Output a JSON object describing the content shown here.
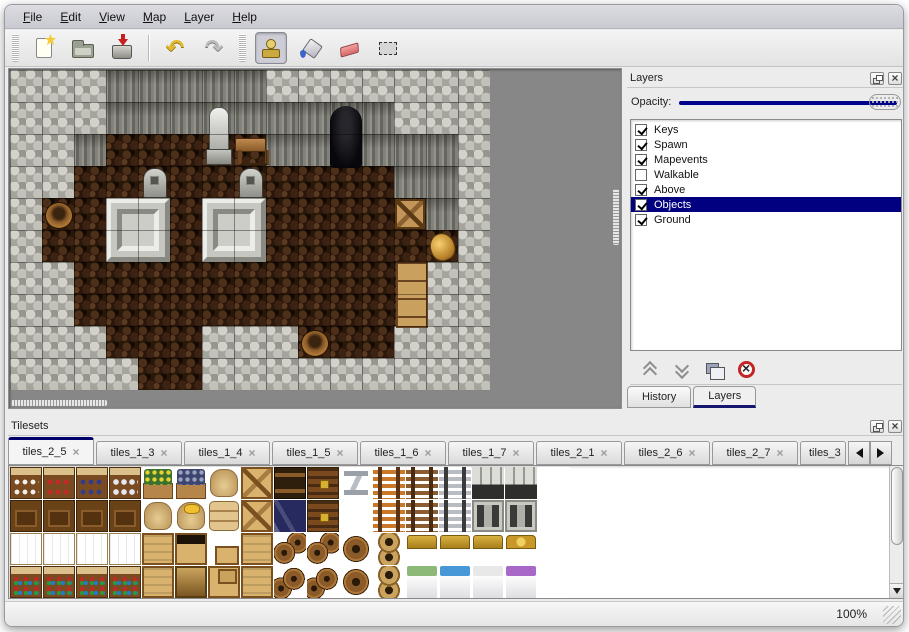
{
  "menu": {
    "items": [
      {
        "label": "File"
      },
      {
        "label": "Edit"
      },
      {
        "label": "View"
      },
      {
        "label": "Map"
      },
      {
        "label": "Layer"
      },
      {
        "label": "Help"
      }
    ]
  },
  "toolbar": {
    "items": [
      "grip",
      "new",
      "open",
      "save",
      "sep",
      "undo",
      "redo",
      "grip",
      "stamp",
      "fill",
      "eraser",
      "select"
    ],
    "active_tool": "stamp"
  },
  "map": {
    "tile_size": 32,
    "legend": {
      "R": "rock",
      "W": "wall",
      "F": "floor"
    },
    "grid": [
      "RRRWWWWWRRRRRRR",
      "RRRWWWWWWWWWRRR",
      "RRWFFFFFWWWWWWR",
      "RRFFFFFFFFFFWWR",
      "RFFFFFFFFFFFFWR",
      "RFFFFFFFFFFFFFR",
      "RRFFFFFFFFFFFRR",
      "RRFFFFFFFFFFFRR",
      "RRRFFFRRRFFFRRR",
      "RRRRFFRRRRRRRRR"
    ],
    "objects": [
      {
        "type": "cave",
        "col": 10,
        "row": 1
      },
      {
        "type": "statue",
        "col": 6,
        "row": 1
      },
      {
        "type": "table",
        "col": 7,
        "row": 2
      },
      {
        "type": "tombstone",
        "col": 4,
        "row": 3
      },
      {
        "type": "tombstone",
        "col": 7,
        "row": 3
      },
      {
        "type": "platform",
        "col": 3,
        "row": 4
      },
      {
        "type": "platform",
        "col": 6,
        "row": 4
      },
      {
        "type": "barrel",
        "col": 1,
        "row": 4
      },
      {
        "type": "crate",
        "col": 12,
        "row": 4
      },
      {
        "type": "vase",
        "col": 13,
        "row": 5
      },
      {
        "type": "shelf",
        "col": 12,
        "row": 6
      },
      {
        "type": "barrel",
        "col": 9,
        "row": 8
      }
    ]
  },
  "layers_panel": {
    "title": "Layers",
    "window_buttons": [
      "float",
      "close"
    ],
    "opacity_label": "Opacity:",
    "opacity_value_percent": 100,
    "layers": [
      {
        "name": "Keys",
        "checked": true,
        "selected": false
      },
      {
        "name": "Spawn",
        "checked": true,
        "selected": false
      },
      {
        "name": "Mapevents",
        "checked": true,
        "selected": false
      },
      {
        "name": "Walkable",
        "checked": false,
        "selected": false
      },
      {
        "name": "Above",
        "checked": true,
        "selected": false
      },
      {
        "name": "Objects",
        "checked": true,
        "selected": true
      },
      {
        "name": "Ground",
        "checked": true,
        "selected": false
      }
    ],
    "buttons": [
      "move-layer-up",
      "move-layer-down",
      "duplicate-layer",
      "delete-layer"
    ],
    "tabs": [
      {
        "label": "History",
        "active": false
      },
      {
        "label": "Layers",
        "active": true
      }
    ]
  },
  "tilesets_panel": {
    "title": "Tilesets",
    "window_buttons": [
      "float",
      "close"
    ],
    "tabs": [
      {
        "label": "tiles_2_5",
        "active": true,
        "truncated": false
      },
      {
        "label": "tiles_1_3",
        "active": false,
        "truncated": false
      },
      {
        "label": "tiles_1_4",
        "active": false,
        "truncated": false
      },
      {
        "label": "tiles_1_5",
        "active": false,
        "truncated": false
      },
      {
        "label": "tiles_1_6",
        "active": false,
        "truncated": false
      },
      {
        "label": "tiles_1_7",
        "active": false,
        "truncated": false
      },
      {
        "label": "tiles_2_1",
        "active": false,
        "truncated": false
      },
      {
        "label": "tiles_2_6",
        "active": false,
        "truncated": false
      },
      {
        "label": "tiles_2_7",
        "active": false,
        "truncated": false
      },
      {
        "label": "tiles_3",
        "active": false,
        "truncated": true
      }
    ],
    "cells": [
      [
        "shelf_dish",
        "shelf_red",
        "shelf_blue",
        "shelf_jar",
        "planter",
        "box_gray",
        "sack",
        "crate_x",
        "crate_dark",
        "chest",
        "metal_z",
        "ladder_o",
        "ladder_b",
        "ladder_g",
        "arch",
        "arch",
        "empty"
      ],
      [
        "cab",
        "cab",
        "cab",
        "cab",
        "sack",
        "sack_gold",
        "sack_stack",
        "crate_x",
        "navy_pile",
        "chest",
        "empty",
        "ladder_o",
        "ladder_b",
        "ladder_g",
        "door",
        "door",
        "empty"
      ],
      [
        "shelf_top",
        "shelf_top",
        "shelf_top",
        "shelf_top",
        "crate_top",
        "crate_open",
        "crate_sm",
        "crate_top",
        "barrels_t",
        "barrels_t",
        "barrel",
        "pots",
        "bed_h",
        "bed_h",
        "bed_h",
        "bed_h3",
        "empty"
      ],
      [
        "shelf_goods",
        "shelf_goods",
        "shelf_goods",
        "shelf_goods",
        "crate_top",
        "crate_dk",
        "crate_st",
        "crate_top",
        "barrels_b",
        "barrels_b",
        "barrel",
        "pots",
        "bed_green",
        "bed_blue",
        "bed_white",
        "bed_purple",
        "empty"
      ]
    ]
  },
  "status": {
    "zoom": "100%"
  },
  "colors": {
    "selection": "#000080",
    "slider_track": "#00008b",
    "active_tab_accent": "#00006a"
  }
}
